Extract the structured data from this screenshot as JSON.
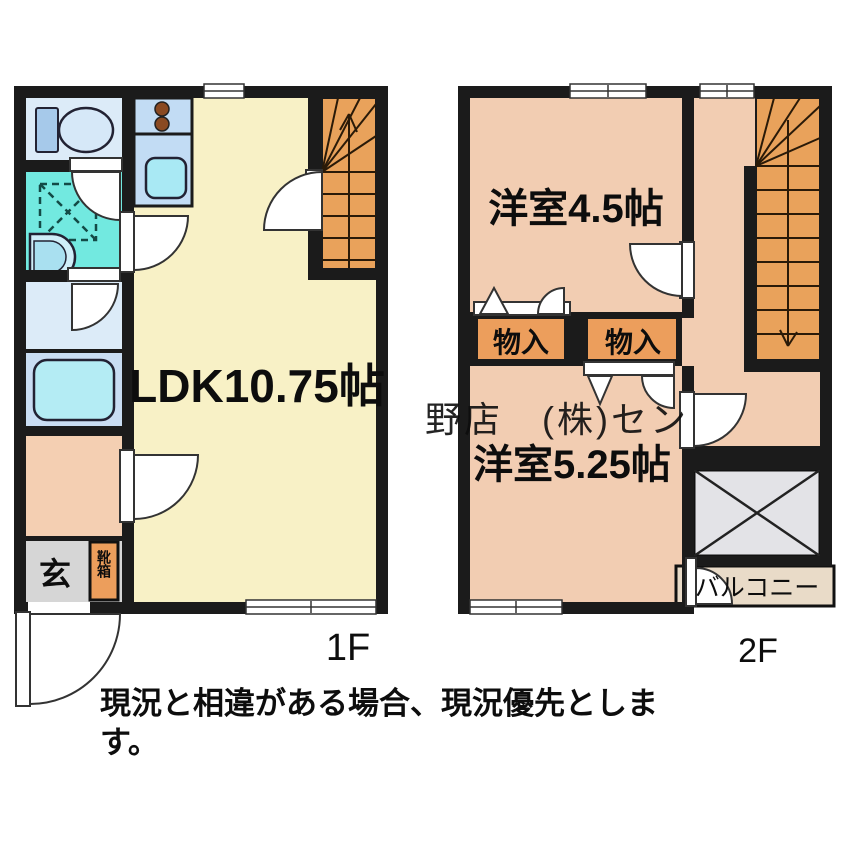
{
  "page": {
    "note_line1": "現況と相違がある場合、現況優先としま",
    "note_line2": "す。",
    "watermark_text": "野店　(株)セン"
  },
  "floor1": {
    "floor_label": "1F",
    "rooms": {
      "ldk": "LDK10.75帖",
      "genkan": "玄",
      "shoebox": "靴箱"
    }
  },
  "floor2": {
    "floor_label": "2F",
    "rooms": {
      "west_room": "洋室4.5帖",
      "south_room": "洋室5.25帖",
      "storage_left": "物入",
      "storage_right": "物入",
      "balcony": "バルコニー"
    }
  },
  "colors": {
    "wall": "#1b1b1b",
    "ldk_floor": "#f8f1c6",
    "floor2_floor": "#f2cdb2",
    "stairs": "#e9a25b",
    "storage": "#ec9e5c",
    "washroom": "#72e9e0",
    "toilet_room": "#dcebf8",
    "bath": "#c9ddf3",
    "tub": "#b4ecf4",
    "kitchen_counter": "#c2dcf4",
    "sink": "#a9e9f4",
    "genkan": "#d6d6d6",
    "hall_1f": "#f4cfb2",
    "void_box": "#e3e3e7",
    "balcony": "#e9dbc8"
  }
}
